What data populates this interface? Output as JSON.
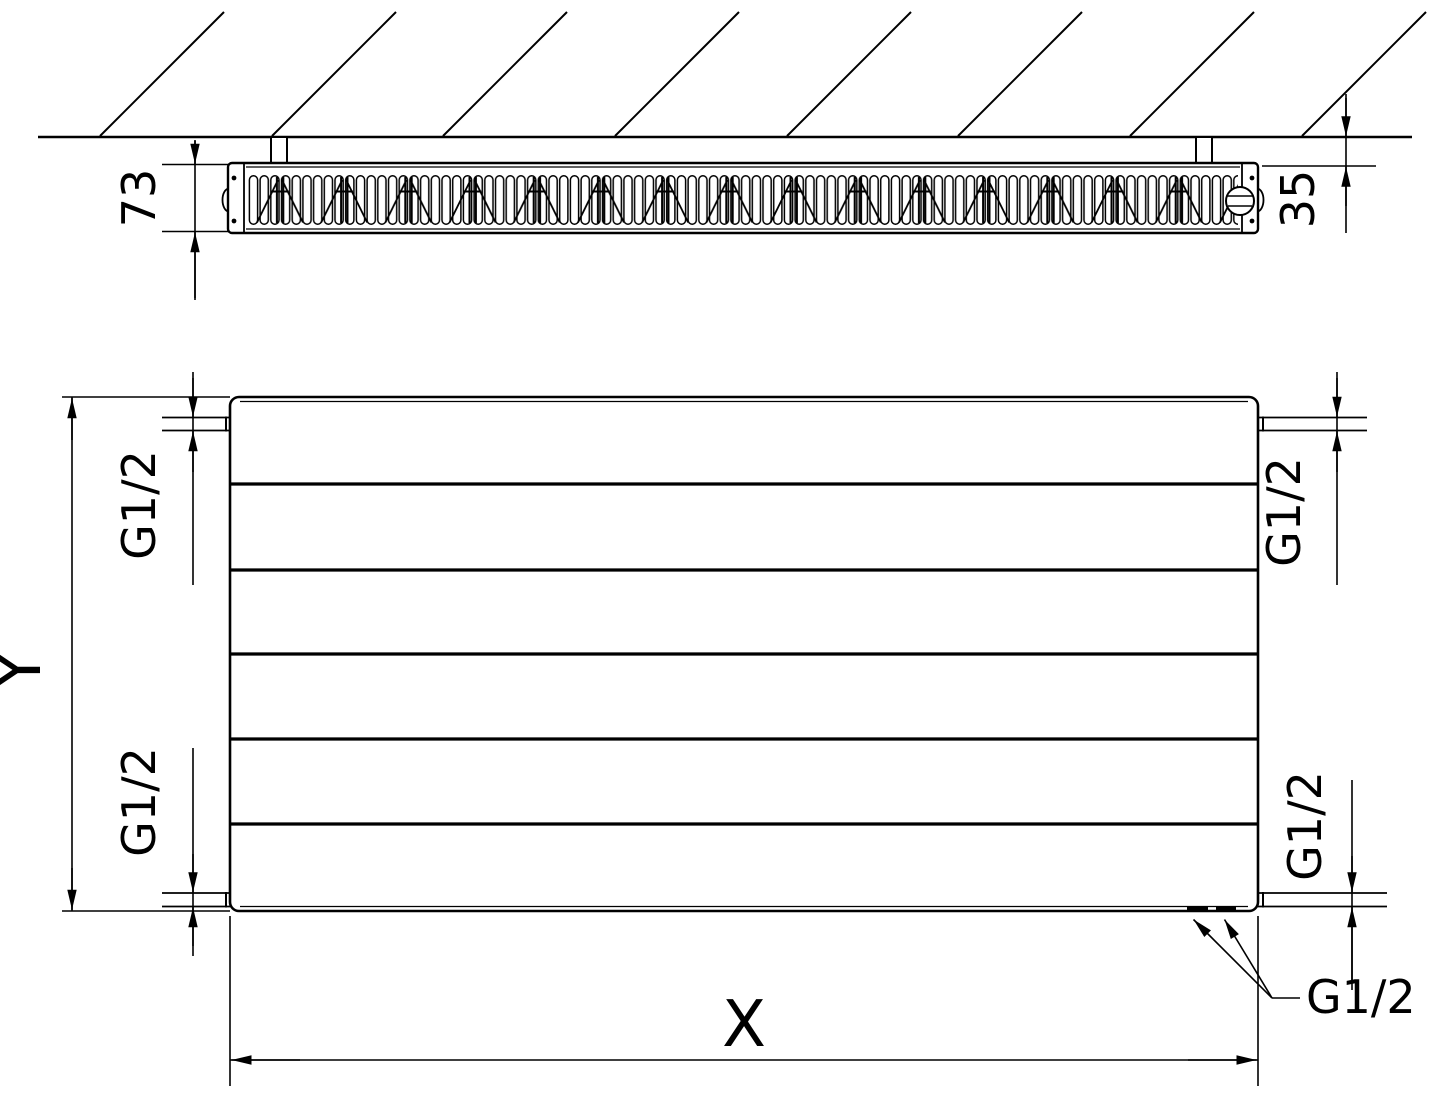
{
  "drawing": {
    "labels": {
      "depth": "73",
      "wall_distance": "35",
      "height": "Y",
      "width": "X",
      "thread_size": "G1/2"
    }
  }
}
